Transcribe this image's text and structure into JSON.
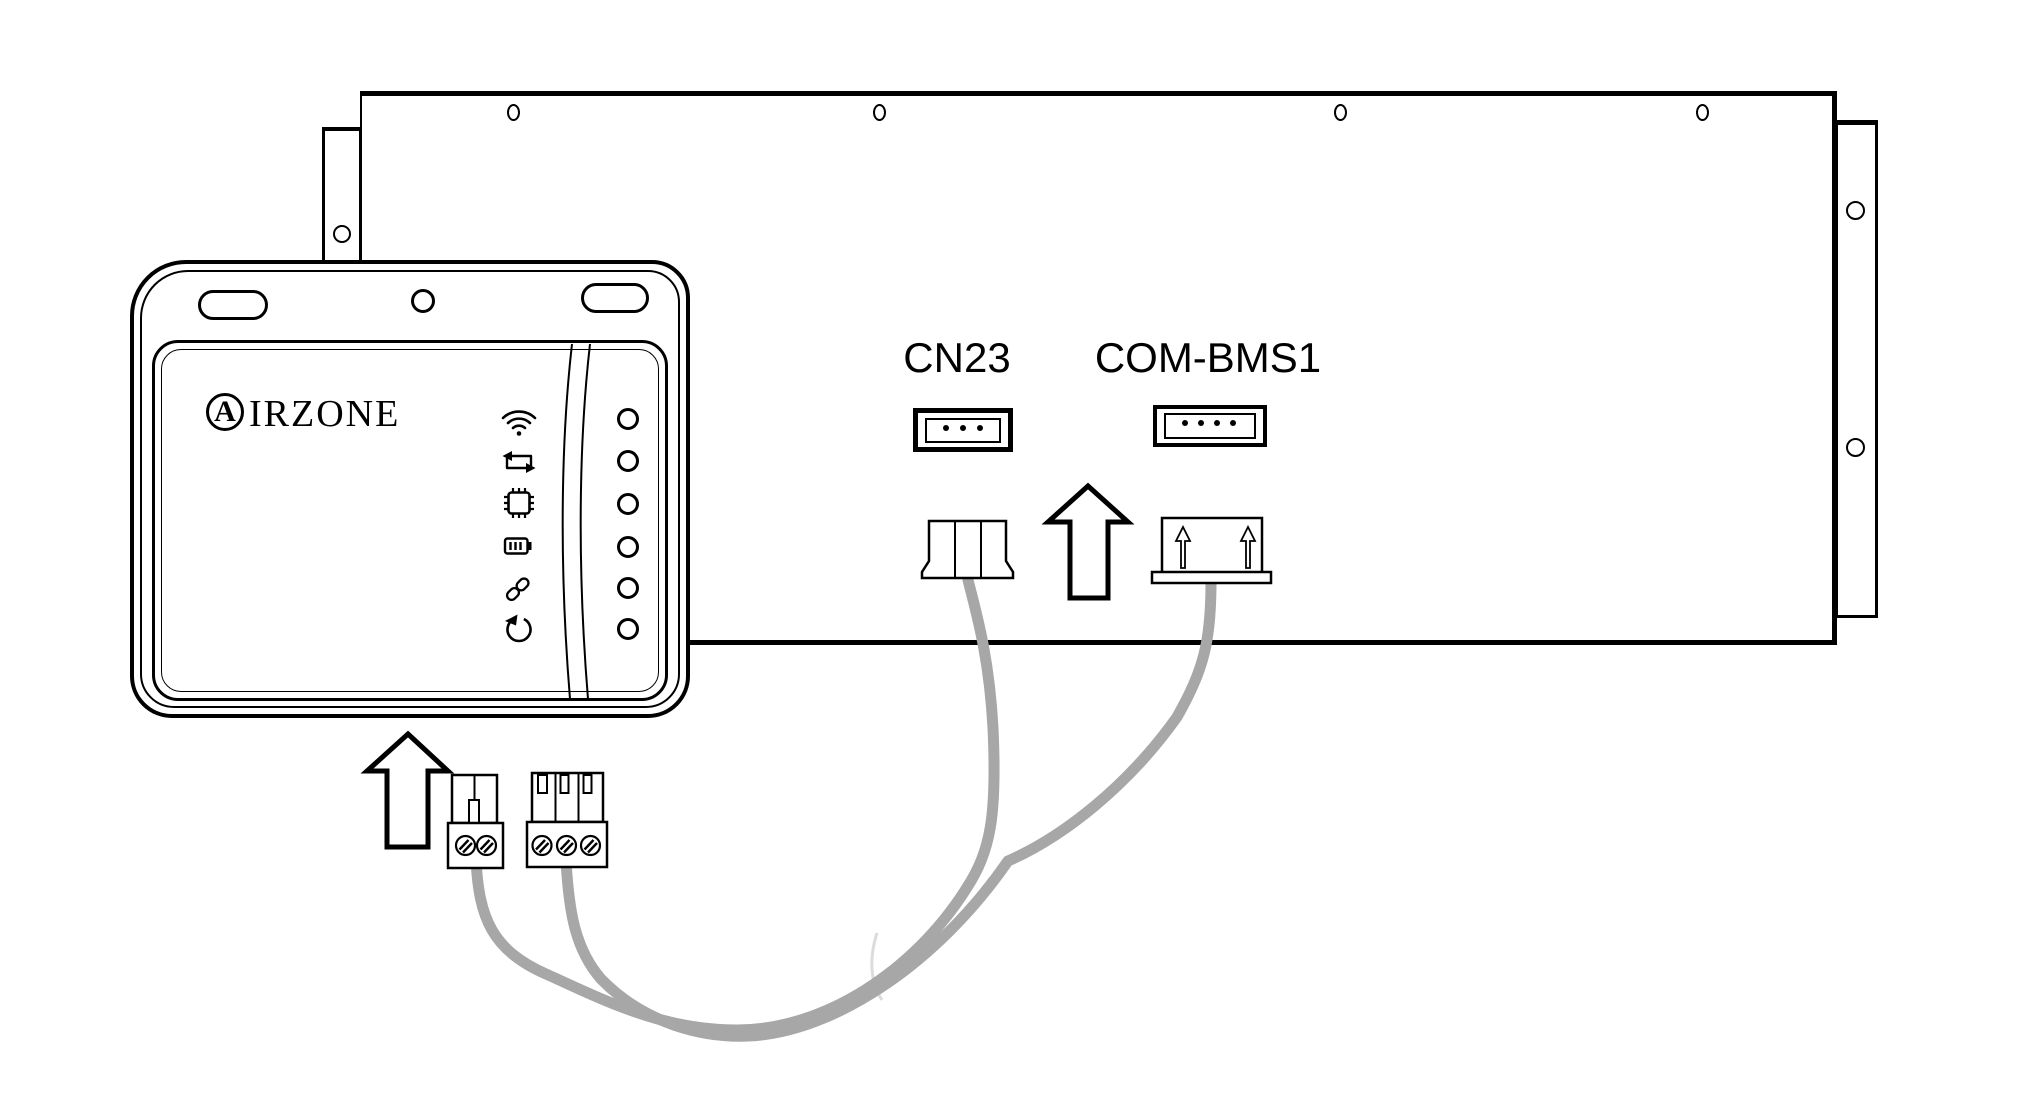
{
  "diagram_type": "installation-wiring-diagram",
  "board": {
    "connector_labels": {
      "cn23": "CN23",
      "com_bms1": "COM-BMS1"
    },
    "cn23_socket_pin_dots": 3,
    "com_bms1_socket_pin_dots": 4,
    "top_mounting_holes": 4,
    "side_flange_holes": 3
  },
  "device": {
    "brand_initial": "A",
    "brand_rest": "IRZONE",
    "status_icons": [
      "wifi-icon",
      "swap-arrows-icon",
      "chip-icon",
      "battery-icon",
      "link-icon",
      "refresh-icon"
    ],
    "led_count": 6
  },
  "colors": {
    "line": "#000000",
    "cable": "#a7a7a7"
  }
}
